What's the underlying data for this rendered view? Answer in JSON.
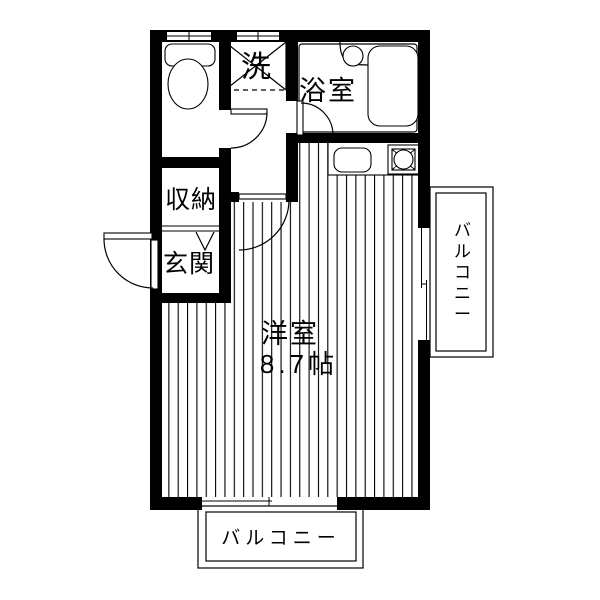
{
  "floorplan": {
    "labels": {
      "laundry": "洗",
      "bathroom": "浴室",
      "closet": "収納",
      "entrance": "玄関",
      "main_room": "洋室",
      "main_room_size": "8.7帖",
      "balcony_right": "バルコニー",
      "balcony_bottom": "バルコニー"
    },
    "colors": {
      "wall": "#000000",
      "background": "#ffffff"
    }
  }
}
